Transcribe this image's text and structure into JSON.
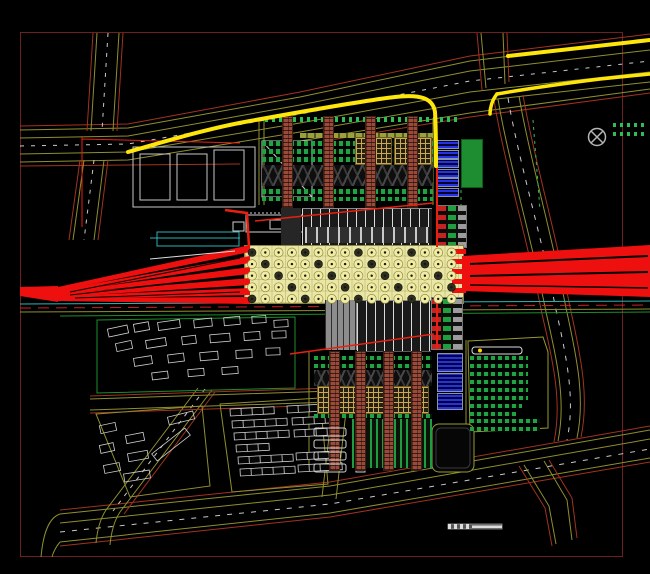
{
  "palette": {
    "background": "#000000",
    "frame": "#6e2020",
    "road_line": "#8f8f2f",
    "road_curb": "#a33220",
    "lane_dash": "#c9c9c9",
    "route_highlight": "#ffe60a",
    "rail_red": "#ee0f0f",
    "plaza_fill": "#eae7a6",
    "tree_fill": "#f0eca6",
    "tree_ring": "#8f8a3c",
    "tree_dark": "#2e2e20",
    "brick_brown": "#9a4a38",
    "hatch_tan": "#caa84e",
    "green_fill": "#1e8c31",
    "parking_green": "#21a243",
    "blue_block": "#2431e8",
    "cyan_line": "#2ab5b5",
    "building_outline": "#d0d0d0",
    "station_dark": "#1a1a1a"
  },
  "symbols": {
    "north_indicator": "crossed-circle-icon",
    "scale_bar": "segmented-scale-bar"
  },
  "plan": {
    "trees": {
      "x0": 252,
      "y0": 252.5,
      "dx": 13.3,
      "dy": 11.6,
      "cols": 16,
      "rows": 5,
      "r": 4.5
    },
    "north_columns": {
      "xs": [
        283,
        324,
        366,
        408
      ],
      "y": 117,
      "h": 90,
      "w": 9
    },
    "south_columns": {
      "xs": [
        330,
        356,
        384,
        412
      ],
      "y": 352,
      "h": 118,
      "w": 9
    },
    "left_fan_apex": [
      20,
      287,
      58,
      286,
      58,
      302,
      20,
      296
    ],
    "left_fan_fingers": [
      [
        58,
        287,
        250,
        245,
        250,
        252,
        58,
        291
      ],
      [
        58,
        290,
        250,
        256,
        250,
        263,
        58,
        293
      ],
      [
        58,
        292,
        250,
        267,
        250,
        274,
        58,
        295
      ],
      [
        58,
        294,
        250,
        278,
        250,
        285,
        58,
        297
      ],
      [
        58,
        296,
        250,
        288,
        250,
        295,
        58,
        299
      ],
      [
        58,
        298,
        250,
        297,
        250,
        304,
        58,
        301
      ]
    ],
    "right_fan_body": [
      462,
      256,
      650,
      245,
      650,
      297,
      462,
      291
    ],
    "right_fan_tips_y": [
      249,
      259,
      269,
      279,
      288
    ],
    "blue_bars_north": {
      "x": 437,
      "y0": 141,
      "w": 21,
      "h": 7,
      "gap": 2.5,
      "count": 6
    },
    "blue_blocks_south": [
      [
        438,
        354,
        24,
        17
      ],
      [
        438,
        374,
        24,
        17
      ],
      [
        438,
        394,
        24,
        15
      ]
    ],
    "east_parking_rows": [
      [
        470,
        356,
        58
      ],
      [
        470,
        364,
        58
      ],
      [
        470,
        372,
        58
      ],
      [
        470,
        380,
        58
      ],
      [
        470,
        388,
        58
      ],
      [
        470,
        396,
        58
      ],
      [
        470,
        404,
        52
      ],
      [
        470,
        412,
        46
      ],
      [
        470,
        419,
        70
      ],
      [
        470,
        427,
        70
      ]
    ],
    "ne_strips": [
      [
        613,
        123,
        33
      ],
      [
        613,
        132,
        33
      ]
    ],
    "south_white_bars": [
      [
        314,
        428,
        32,
        8
      ],
      [
        314,
        440,
        32,
        8
      ],
      [
        314,
        452,
        32,
        8
      ],
      [
        314,
        464,
        32,
        8
      ]
    ],
    "residential": [
      [
        108,
        327,
        20,
        8,
        -12
      ],
      [
        134,
        323,
        15,
        8,
        -10
      ],
      [
        158,
        321,
        22,
        8,
        -8
      ],
      [
        194,
        319,
        18,
        8,
        -6
      ],
      [
        224,
        317,
        16,
        8,
        -5
      ],
      [
        252,
        316,
        14,
        7,
        -4
      ],
      [
        274,
        320,
        14,
        7,
        -3
      ],
      [
        116,
        342,
        16,
        8,
        -12
      ],
      [
        146,
        339,
        20,
        8,
        -9
      ],
      [
        182,
        336,
        14,
        8,
        -7
      ],
      [
        210,
        334,
        20,
        8,
        -5
      ],
      [
        244,
        332,
        16,
        8,
        -4
      ],
      [
        272,
        331,
        14,
        7,
        -2
      ],
      [
        134,
        357,
        18,
        8,
        -9
      ],
      [
        168,
        354,
        16,
        8,
        -7
      ],
      [
        200,
        352,
        18,
        8,
        -5
      ],
      [
        236,
        350,
        16,
        8,
        -3
      ],
      [
        266,
        348,
        14,
        7,
        -2
      ],
      [
        152,
        372,
        16,
        7,
        -7
      ],
      [
        188,
        369,
        16,
        7,
        -5
      ],
      [
        222,
        367,
        16,
        7,
        -4
      ],
      [
        100,
        424,
        16,
        8,
        -12
      ],
      [
        126,
        434,
        18,
        8,
        -11
      ],
      [
        100,
        444,
        14,
        8,
        -12
      ],
      [
        128,
        452,
        20,
        8,
        -10
      ],
      [
        104,
        464,
        16,
        8,
        -11
      ],
      [
        150,
        440,
        42,
        9,
        -38
      ],
      [
        168,
        414,
        26,
        8,
        -14
      ],
      [
        124,
        472,
        26,
        8,
        -9
      ]
    ],
    "terrace_rows": {
      "cellw": 11,
      "cellh": 7,
      "rot": -3,
      "groups": [
        [
          230,
          409,
          4
        ],
        [
          287,
          406,
          4
        ],
        [
          232,
          421,
          5
        ],
        [
          292,
          418,
          4
        ],
        [
          234,
          433,
          5
        ],
        [
          294,
          430,
          3
        ],
        [
          236,
          445,
          3
        ],
        [
          238,
          457,
          5
        ],
        [
          296,
          453,
          4
        ],
        [
          240,
          469,
          5
        ],
        [
          298,
          465,
          4
        ]
      ]
    }
  }
}
